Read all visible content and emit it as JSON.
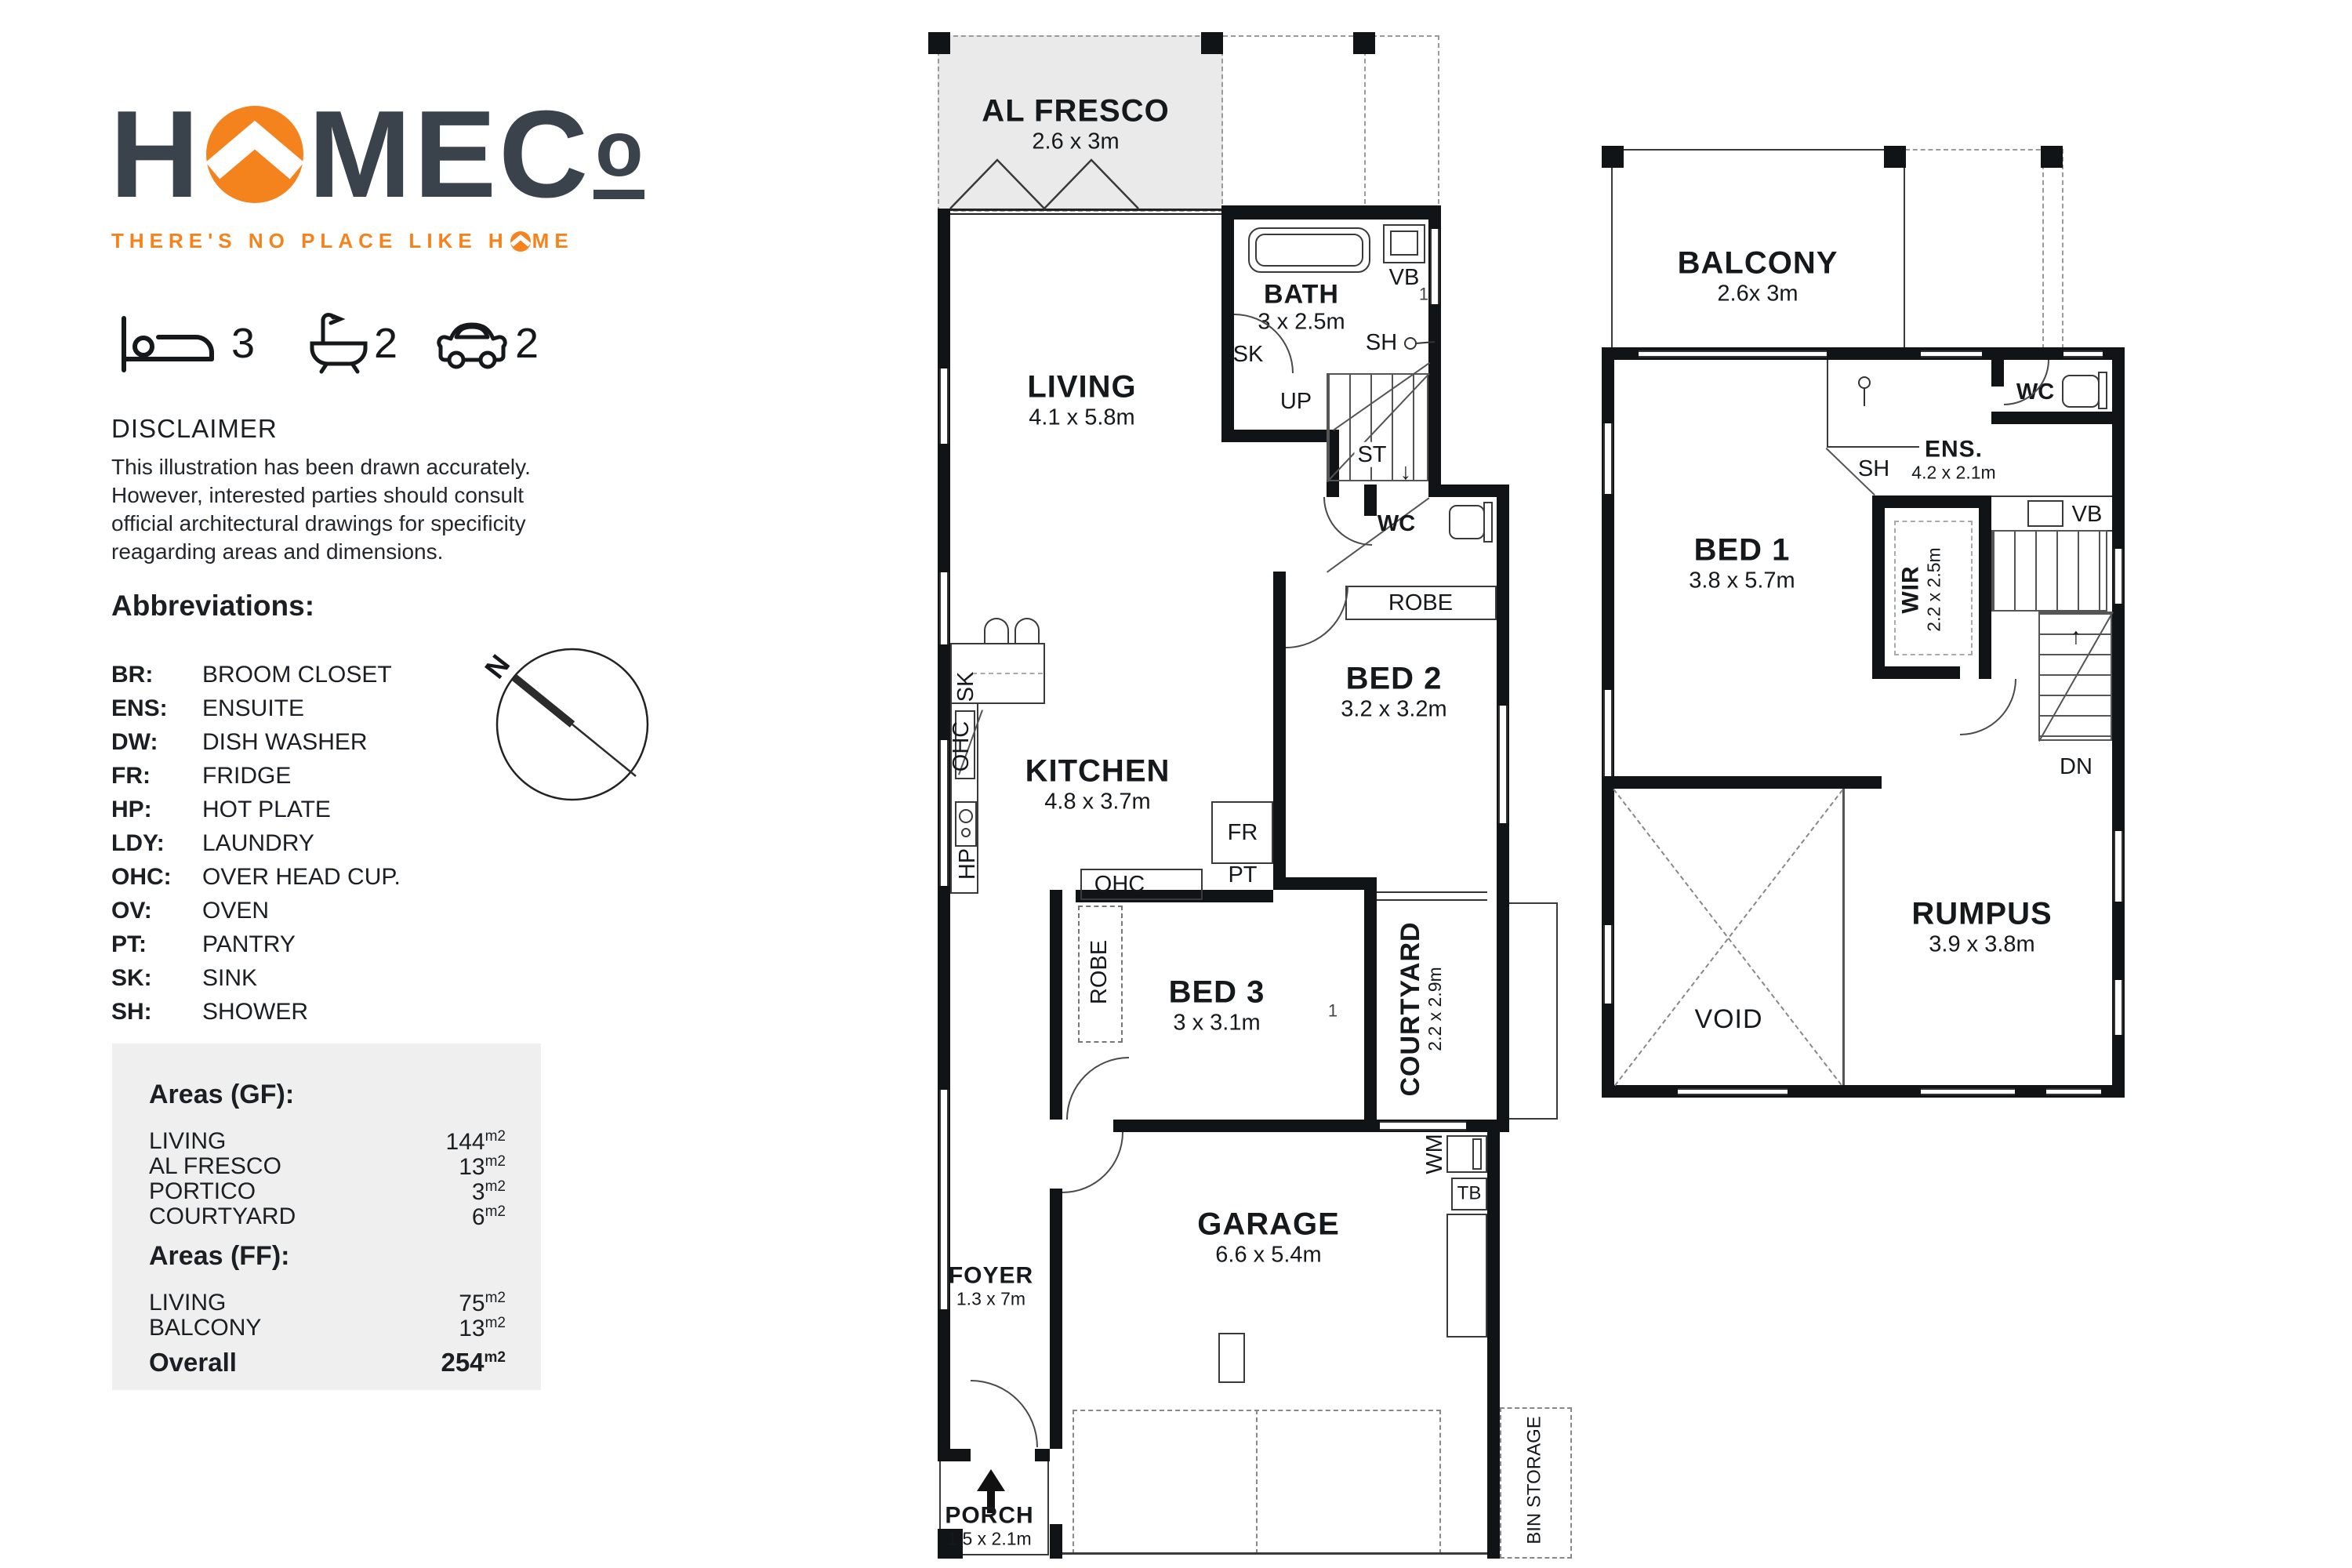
{
  "colors": {
    "accent_orange": "#f5831d",
    "charcoal": "#3a434b",
    "plan_line": "#101417",
    "areas_box_bg": "#efefef",
    "alfresco_fill": "#eaeaea"
  },
  "brand": {
    "word_start": "H",
    "word_mid": "MEC",
    "word_end": "o",
    "tagline_pre": "THERE'S NO PLACE LIKE H",
    "tagline_post": "ME"
  },
  "stats": [
    {
      "icon": "bed-icon",
      "value": "3"
    },
    {
      "icon": "bath-icon",
      "value": "2"
    },
    {
      "icon": "car-icon",
      "value": "2"
    }
  ],
  "disclaimer": {
    "title": "DISCLAIMER",
    "body": "This illustration has been drawn accurately. However, interested parties should consult official architectural drawings for specificity reagarding areas and dimensions."
  },
  "abbreviations": {
    "title": "Abbreviations:",
    "items": [
      {
        "abbr": "BR:",
        "meaning": "BROOM CLOSET"
      },
      {
        "abbr": "ENS:",
        "meaning": "ENSUITE"
      },
      {
        "abbr": "DW:",
        "meaning": "DISH WASHER"
      },
      {
        "abbr": "FR:",
        "meaning": "FRIDGE"
      },
      {
        "abbr": "HP:",
        "meaning": "HOT PLATE"
      },
      {
        "abbr": "LDY:",
        "meaning": "LAUNDRY"
      },
      {
        "abbr": "OHC:",
        "meaning": "OVER HEAD CUP."
      },
      {
        "abbr": "OV:",
        "meaning": "OVEN"
      },
      {
        "abbr": "PT:",
        "meaning": "PANTRY"
      },
      {
        "abbr": "SK:",
        "meaning": "SINK"
      },
      {
        "abbr": "SH:",
        "meaning": "SHOWER"
      }
    ]
  },
  "compass": {
    "north_label": "N"
  },
  "areas": {
    "gf_title": "Areas (GF):",
    "gf_rows": [
      {
        "label": "LIVING",
        "value": "144",
        "unit": "m2"
      },
      {
        "label": "AL FRESCO",
        "value": "13",
        "unit": "m2"
      },
      {
        "label": "PORTICO",
        "value": "3",
        "unit": "m2"
      },
      {
        "label": "COURTYARD",
        "value": "6",
        "unit": "m2"
      }
    ],
    "ff_title": "Areas (FF):",
    "ff_rows": [
      {
        "label": "LIVING",
        "value": "75",
        "unit": "m2"
      },
      {
        "label": "BALCONY",
        "value": "13",
        "unit": "m2"
      }
    ],
    "overall_label": "Overall",
    "overall_value": "254",
    "overall_unit": "m2"
  },
  "gf": {
    "rooms": {
      "al_fresco": {
        "name": "AL FRESCO",
        "dims": "2.6 x 3m"
      },
      "living": {
        "name": "LIVING",
        "dims": "4.1 x 5.8m"
      },
      "bath": {
        "name": "BATH",
        "dims": "3 x 2.5m"
      },
      "kitchen": {
        "name": "KITCHEN",
        "dims": "4.8 x 3.7m"
      },
      "bed2": {
        "name": "BED 2",
        "dims": "3.2 x 3.2m"
      },
      "bed3": {
        "name": "BED 3",
        "dims": "3 x 3.1m"
      },
      "courtyard": {
        "name": "COURTYARD",
        "dims": "2.2 x 2.9m"
      },
      "garage": {
        "name": "GARAGE",
        "dims": "6.6 x 5.4m"
      },
      "foyer": {
        "name": "FOYER",
        "dims": "1.3 x 7m"
      },
      "porch": {
        "name": "PORCH",
        "dims": "1.5 x 2.1m"
      }
    },
    "labels": {
      "vb": "VB",
      "win1": "1",
      "sk_bath": "SK",
      "sh": "SH",
      "up": "UP",
      "st": "ST",
      "down_arrow": "↓",
      "wc": "WC",
      "robe2": "ROBE",
      "fr": "FR",
      "pt": "PT",
      "ohc_wall": "OHC",
      "sk_bench": "SK",
      "hp": "HP",
      "ohc_mid": "OHC",
      "robe3": "ROBE",
      "win2": "1",
      "wm": "WM",
      "tb": "TB",
      "bin": "BIN STORAGE"
    }
  },
  "ff": {
    "rooms": {
      "balcony": {
        "name": "BALCONY",
        "dims": "2.6x 3m"
      },
      "bed1": {
        "name": "BED 1",
        "dims": "3.8 x 5.7m"
      },
      "ens": {
        "name": "ENS.",
        "dims": "4.2 x 2.1m"
      },
      "wir": {
        "name": "WIR",
        "dims": "2.2 x 2.5m"
      },
      "rumpus": {
        "name": "RUMPUS",
        "dims": "3.9 x 3.8m"
      }
    },
    "labels": {
      "sh": "SH",
      "wc": "WC",
      "vb": "VB",
      "dn": "DN",
      "void": "VOID",
      "up_arrow": "↑"
    }
  }
}
